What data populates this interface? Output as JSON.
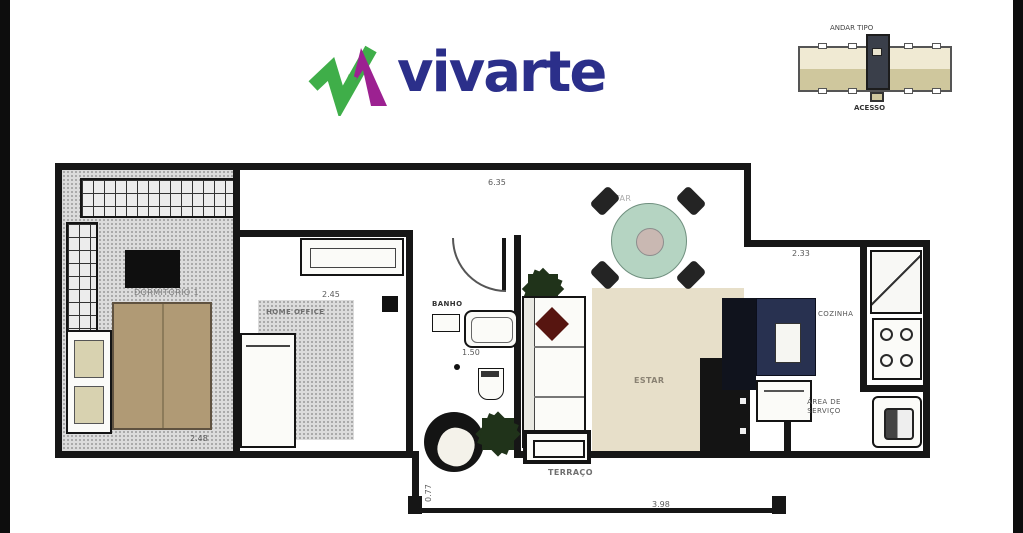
{
  "logo": {
    "brand": "vivarte"
  },
  "key_plan": {
    "title": "ANDAR TIPO",
    "caption": "ACESSO"
  },
  "plan": {
    "rooms": {
      "dormitorio": "DORMITÓRIO 1",
      "home_office": "HOME OFFICE",
      "banho": "BANHO",
      "jantar": "JANTAR",
      "estar": "ESTAR",
      "cozinha": "COZINHA",
      "area_servico": "ÁREA DE SERVIÇO",
      "terraco": "TERRAÇO"
    },
    "dimensions": {
      "top_width": "6.35",
      "home_office_width": "2.45",
      "kitchen_width": "2.33",
      "banho_width": "1.50",
      "dormitorio_width": "2.48",
      "terraco_width": "3.98",
      "terraco_depth": "0.77"
    },
    "colors": {
      "wall": "#161616",
      "floor_gray": "#dcdcdc",
      "floor_beige": "#e7dfc9",
      "bed_tan": "#b09a75",
      "dining_green": "#b5d4c2",
      "kitchen_navy": "#283150",
      "logo_navy": "#2b2f8a",
      "logo_green": "#3fae49",
      "logo_purple": "#9c2191"
    }
  }
}
